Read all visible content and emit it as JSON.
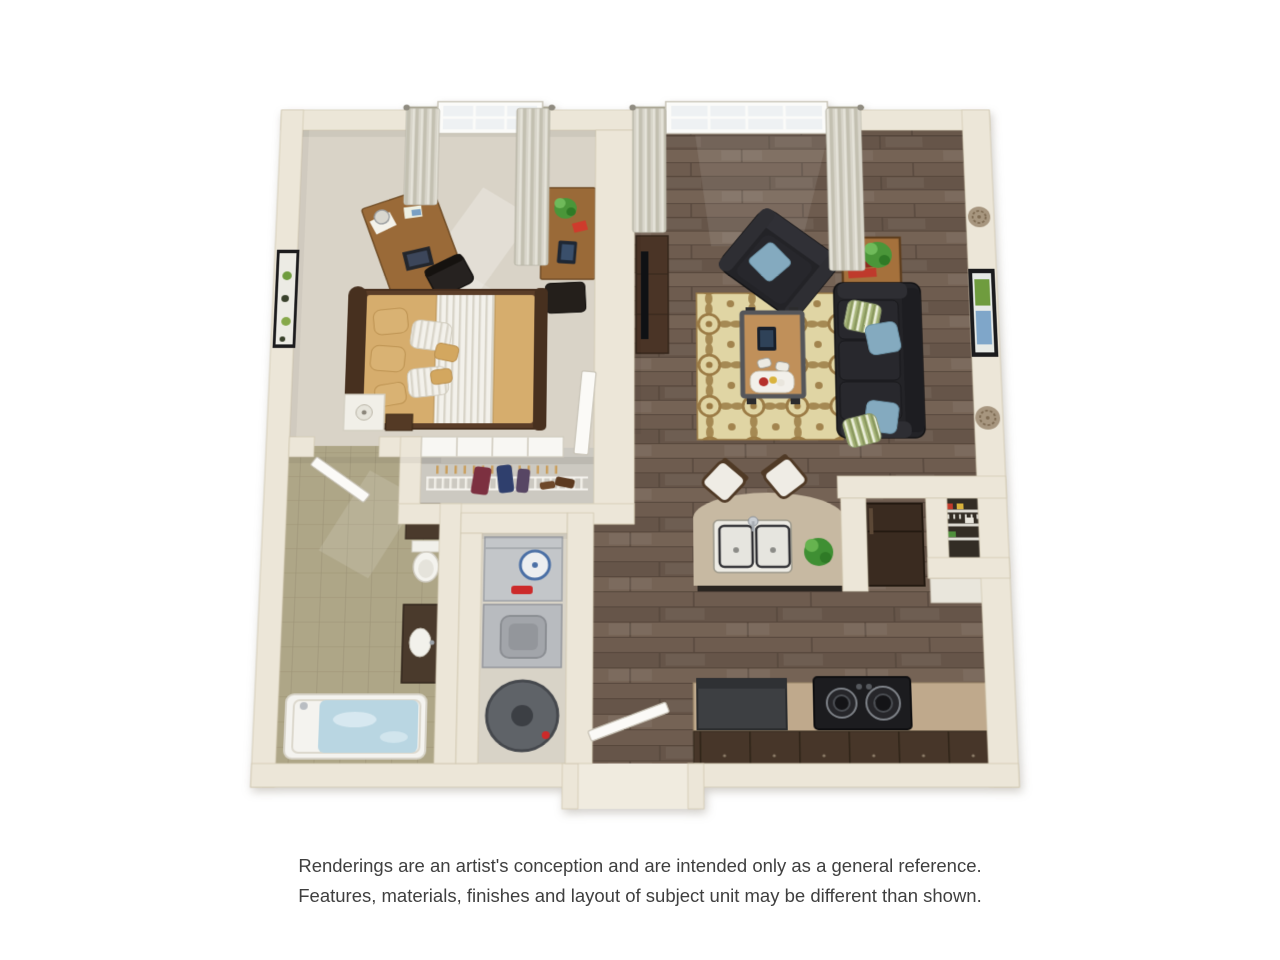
{
  "meta": {
    "title": "3D floor plan rendering",
    "view": "top-down 3D dollhouse view",
    "unit": "one bedroom / one bathroom apartment"
  },
  "disclaimer": {
    "line1": "Renderings are an artist's conception and are intended only as a general reference.",
    "line2": "Features, materials, finishes and layout of subject unit may be different than shown."
  },
  "palette": {
    "background": "#ffffff",
    "wall": "#ece6d8",
    "wall_edge": "#d2c8b2",
    "carpet": "#d9d3c7",
    "wood_floor": "#6e5c4f",
    "bathroom_tile": "#aea687",
    "closet_floor": "#ccc9c1",
    "utility_floor": "#d8d3c7",
    "rug_base": "#e0d5a4",
    "rug_motif": "#9b7b45",
    "sofa_black": "#232327",
    "pillow_blue": "#84aabf",
    "pillow_stripe_green": "#a3b275",
    "bed_tan": "#d6ad6d",
    "bed_white": "#f3f1eb",
    "bed_frame": "#5a3d28",
    "desk_wood": "#9a6a38",
    "tv_console": "#4a3426",
    "side_table": "#a5713c",
    "coffee_table_top": "#c0905a",
    "island_counter": "#c7b9a2",
    "counter_tan": "#bfa98c",
    "cabinet_dark": "#473629",
    "fridge_brown": "#3a2b20",
    "stool_white": "#efece5",
    "appliance_gray": "#c3c6c9",
    "water_heater_gray": "#5f6368",
    "tub_white": "#f4f3ef",
    "water_blue": "#b9d6e2",
    "curtain": "#d8d5ca",
    "window_glass": "#eef1f3",
    "door_white": "#fbfaf7",
    "plant_green": "#4a9639",
    "accent_red": "#c23a2b",
    "accent_gold": "#d9b33c",
    "text": "#3f3f3f"
  },
  "plan": {
    "rooms": [
      {
        "name": "bedroom",
        "position": "top-left",
        "floor": "carpet",
        "items": [
          "window with two curtain panels",
          "writing desk with lamp, laptop and papers",
          "desk chair",
          "second desk with potted plant, red notebook and tablet",
          "second desk chair",
          "queen bed with dark wood frame, tan comforter, white striped blanket, tan and striped pillows",
          "white nightstand with lamp",
          "small wood side table",
          "framed artwork on west wall",
          "sunlight patches on carpet"
        ]
      },
      {
        "name": "closet",
        "position": "center",
        "floor": "light gray",
        "items": [
          "white sliding panel doors",
          "ventilated wire shelf",
          "wood hangers",
          "hanging clothes (red, navy, purple)",
          "shoes"
        ]
      },
      {
        "name": "living-room",
        "position": "top-right",
        "floor": "dark hardwood",
        "items": [
          "window with two curtain panels",
          "media console with flat TV",
          "black leather armchair with blue pillow",
          "wood side table with plant and red books",
          "black leather sofa with two blue and two striped pillows",
          "gold patterned area rug",
          "coffee table with tablet, two game controllers and snack tray",
          "framed artwork on east wall",
          "two decorative wall medallions"
        ]
      },
      {
        "name": "bathroom",
        "position": "bottom-left",
        "floor": "tan tile",
        "items": [
          "dark wall cabinet",
          "toilet",
          "dark vanity with white sink",
          "soaking tub filled with water",
          "swing door from hall"
        ]
      },
      {
        "name": "laundry-utility-closet",
        "position": "bottom-center",
        "floor": "beige",
        "items": [
          "washer with round dial and red detergent",
          "dryer with round door",
          "cylindrical water heater"
        ]
      },
      {
        "name": "kitchen-dining",
        "position": "bottom-right",
        "floor": "dark hardwood",
        "items": [
          "curved breakfast island with double stainless sink and faucet",
          "two white bar stools",
          "potted plant on island",
          "dark refrigerator",
          "pantry with wire shelves and goods",
          "white counter nook",
          "dishwasher",
          "tan counter run",
          "black cooktop with two burners",
          "dark base cabinets"
        ]
      },
      {
        "name": "entry",
        "position": "bottom-center",
        "floor": "porch recess",
        "items": [
          "open white front door",
          "recessed porch walls"
        ]
      }
    ],
    "counts": {
      "bar_stools": 2,
      "cooktop_burners": 2,
      "wall_medallions": 2,
      "sofa_pillows": 4,
      "bed_pillows": 7,
      "curtain_panels": 4
    }
  }
}
